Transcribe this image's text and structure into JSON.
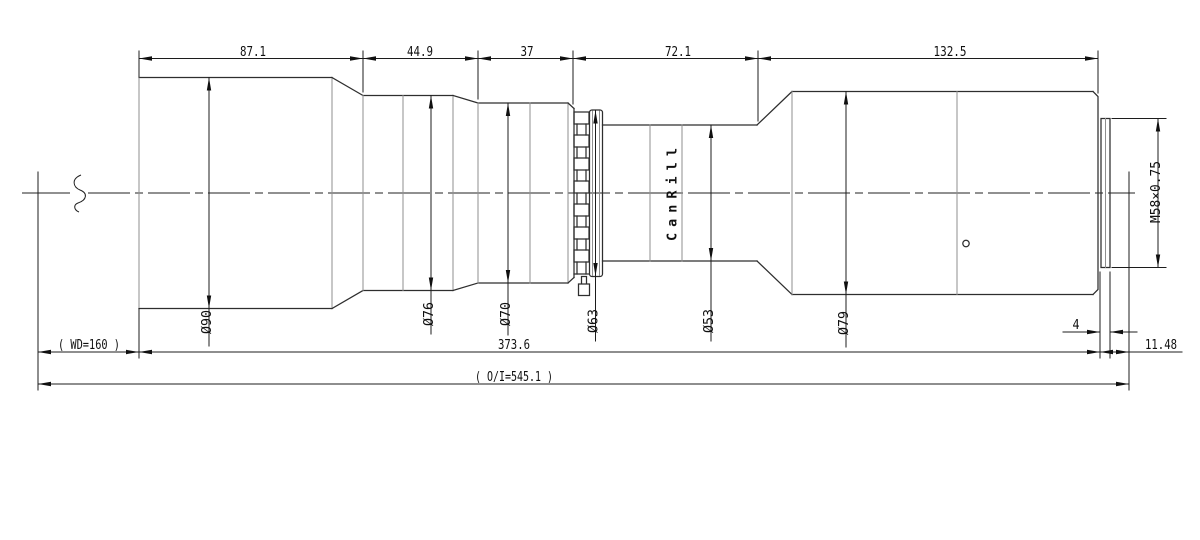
{
  "drawing": {
    "brand": "CanRill",
    "top_dims": [
      "87.1",
      "44.9",
      "37",
      "72.1",
      "132.5"
    ],
    "diameters": [
      "Ø90",
      "Ø76",
      "Ø70",
      "Ø63",
      "Ø53",
      "Ø79"
    ],
    "thread": "M58×0.75",
    "bottom_dims": {
      "working_distance": "( WD=160 )",
      "barrel_length": "373.6",
      "thread_length": "4",
      "flange_back": "11.48",
      "object_to_image": "( O/I=545.1 )"
    }
  }
}
